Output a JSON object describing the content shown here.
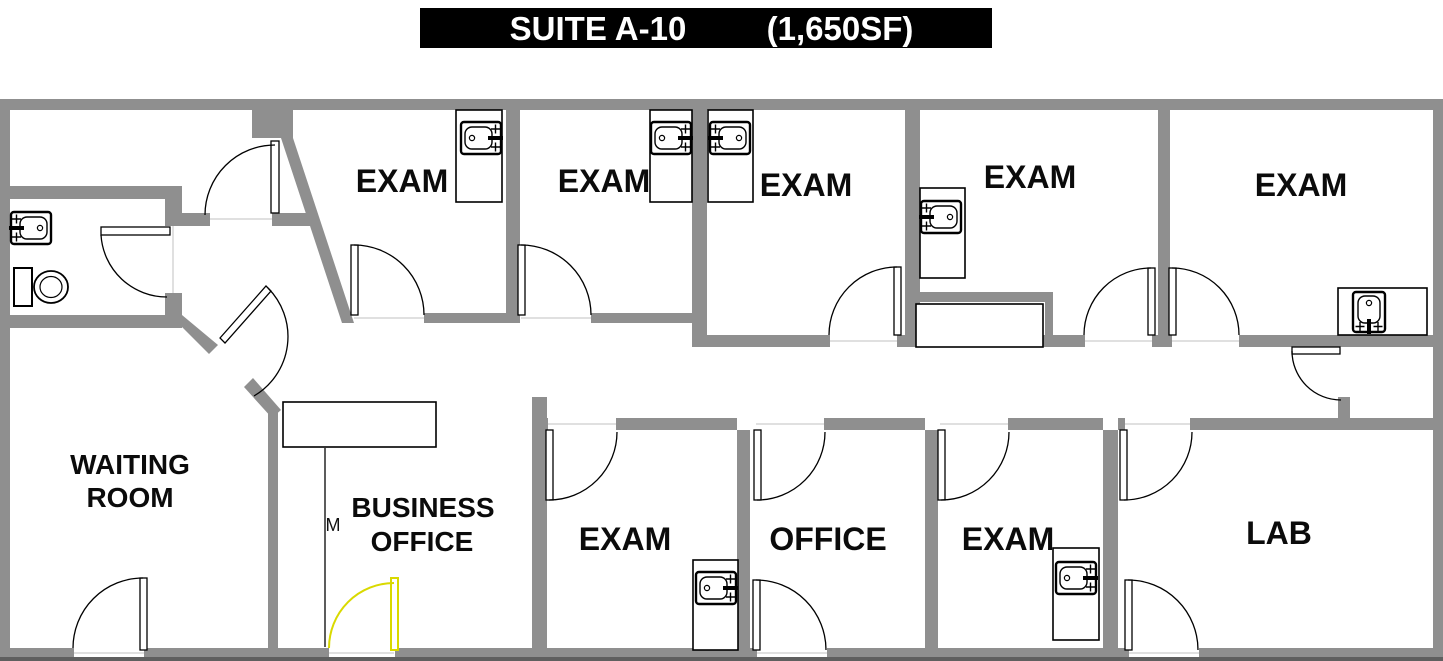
{
  "title": {
    "suite": "SUITE A-10",
    "area": "(1,650SF)"
  },
  "rooms": {
    "waiting_room": {
      "label_line1": "WAITING",
      "label_line2": "ROOM"
    },
    "business_office": {
      "label_line1": "BUSINESS",
      "label_line2": "OFFICE",
      "wall_marker": "M"
    },
    "exam_labels": [
      "EXAM",
      "EXAM",
      "EXAM",
      "EXAM",
      "EXAM",
      "EXAM",
      "EXAM"
    ],
    "office": {
      "label": "OFFICE"
    },
    "lab": {
      "label": "LAB"
    }
  },
  "fixtures": {
    "sink_icon_count": 8,
    "toilet_icon_count": 1,
    "door_swing_count": 17,
    "counter_count": 9,
    "highlighted_entry_door": "yellow"
  },
  "colors": {
    "wall": "#8F8F8F",
    "line": "#000000",
    "floor": "#FFFFFF",
    "door_highlight": "#D9D900",
    "title_bg": "#000000",
    "title_text": "#FFFFFF"
  }
}
